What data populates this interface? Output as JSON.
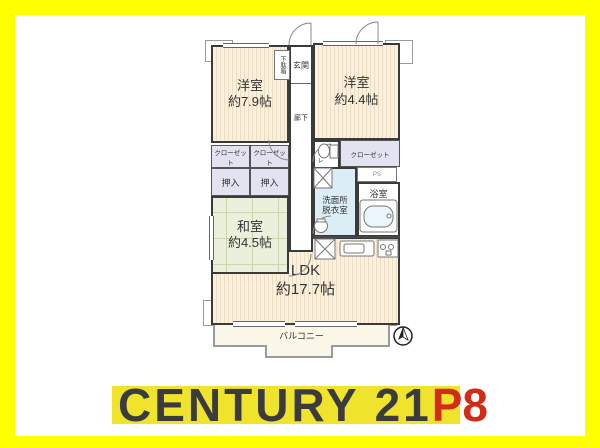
{
  "branding": {
    "brand": "CENTURY 21",
    "franchise": "P8"
  },
  "floorplan": {
    "rooms": {
      "western1": {
        "name": "洋室",
        "size": "約7.9帖"
      },
      "western2": {
        "name": "洋室",
        "size": "約4.4帖"
      },
      "japanese": {
        "name": "和室",
        "size": "約4.5帖"
      },
      "ldk": {
        "name": "LDK",
        "size": "約17.7帖"
      }
    },
    "labels": {
      "genkan": "玄関",
      "shoe_cabinet": "下駄箱",
      "hallway": "廊下",
      "closet_left_1": "クローゼット",
      "closet_left_2": "クローゼット",
      "closet_right": "クローゼット",
      "oshiire_1": "押入",
      "oshiire_2": "押入",
      "toilet": "トイレ",
      "pipe_space": "PS",
      "washroom_line1": "洗面所",
      "washroom_line2": "脱衣室",
      "bathroom": "浴室",
      "balcony": "バルコニー"
    },
    "icons": {
      "compass": "north-arrow",
      "bathtub": "bathtub",
      "toilet": "toilet-bowl",
      "washer_space": "washing-machine-space",
      "fridge_space": "refrigerator-space",
      "kitchen_sink": "kitchen-sink",
      "stove": "stove"
    },
    "colors": {
      "border_yellow": "#FFFF00",
      "strip_yellow": "#EFE32B",
      "brand_text": "#3B3B3D",
      "franchise_red": "#D22C18",
      "room_cream": "#F9F0DE",
      "room_stripe": "#EDDEC3",
      "tatami_green": "#EAF0DB",
      "closet_lavender": "#E3E2F1",
      "washroom_blue": "#DCEEF5",
      "balcony_cream": "#FAF6E8",
      "wall": "#3A3A3A"
    }
  }
}
